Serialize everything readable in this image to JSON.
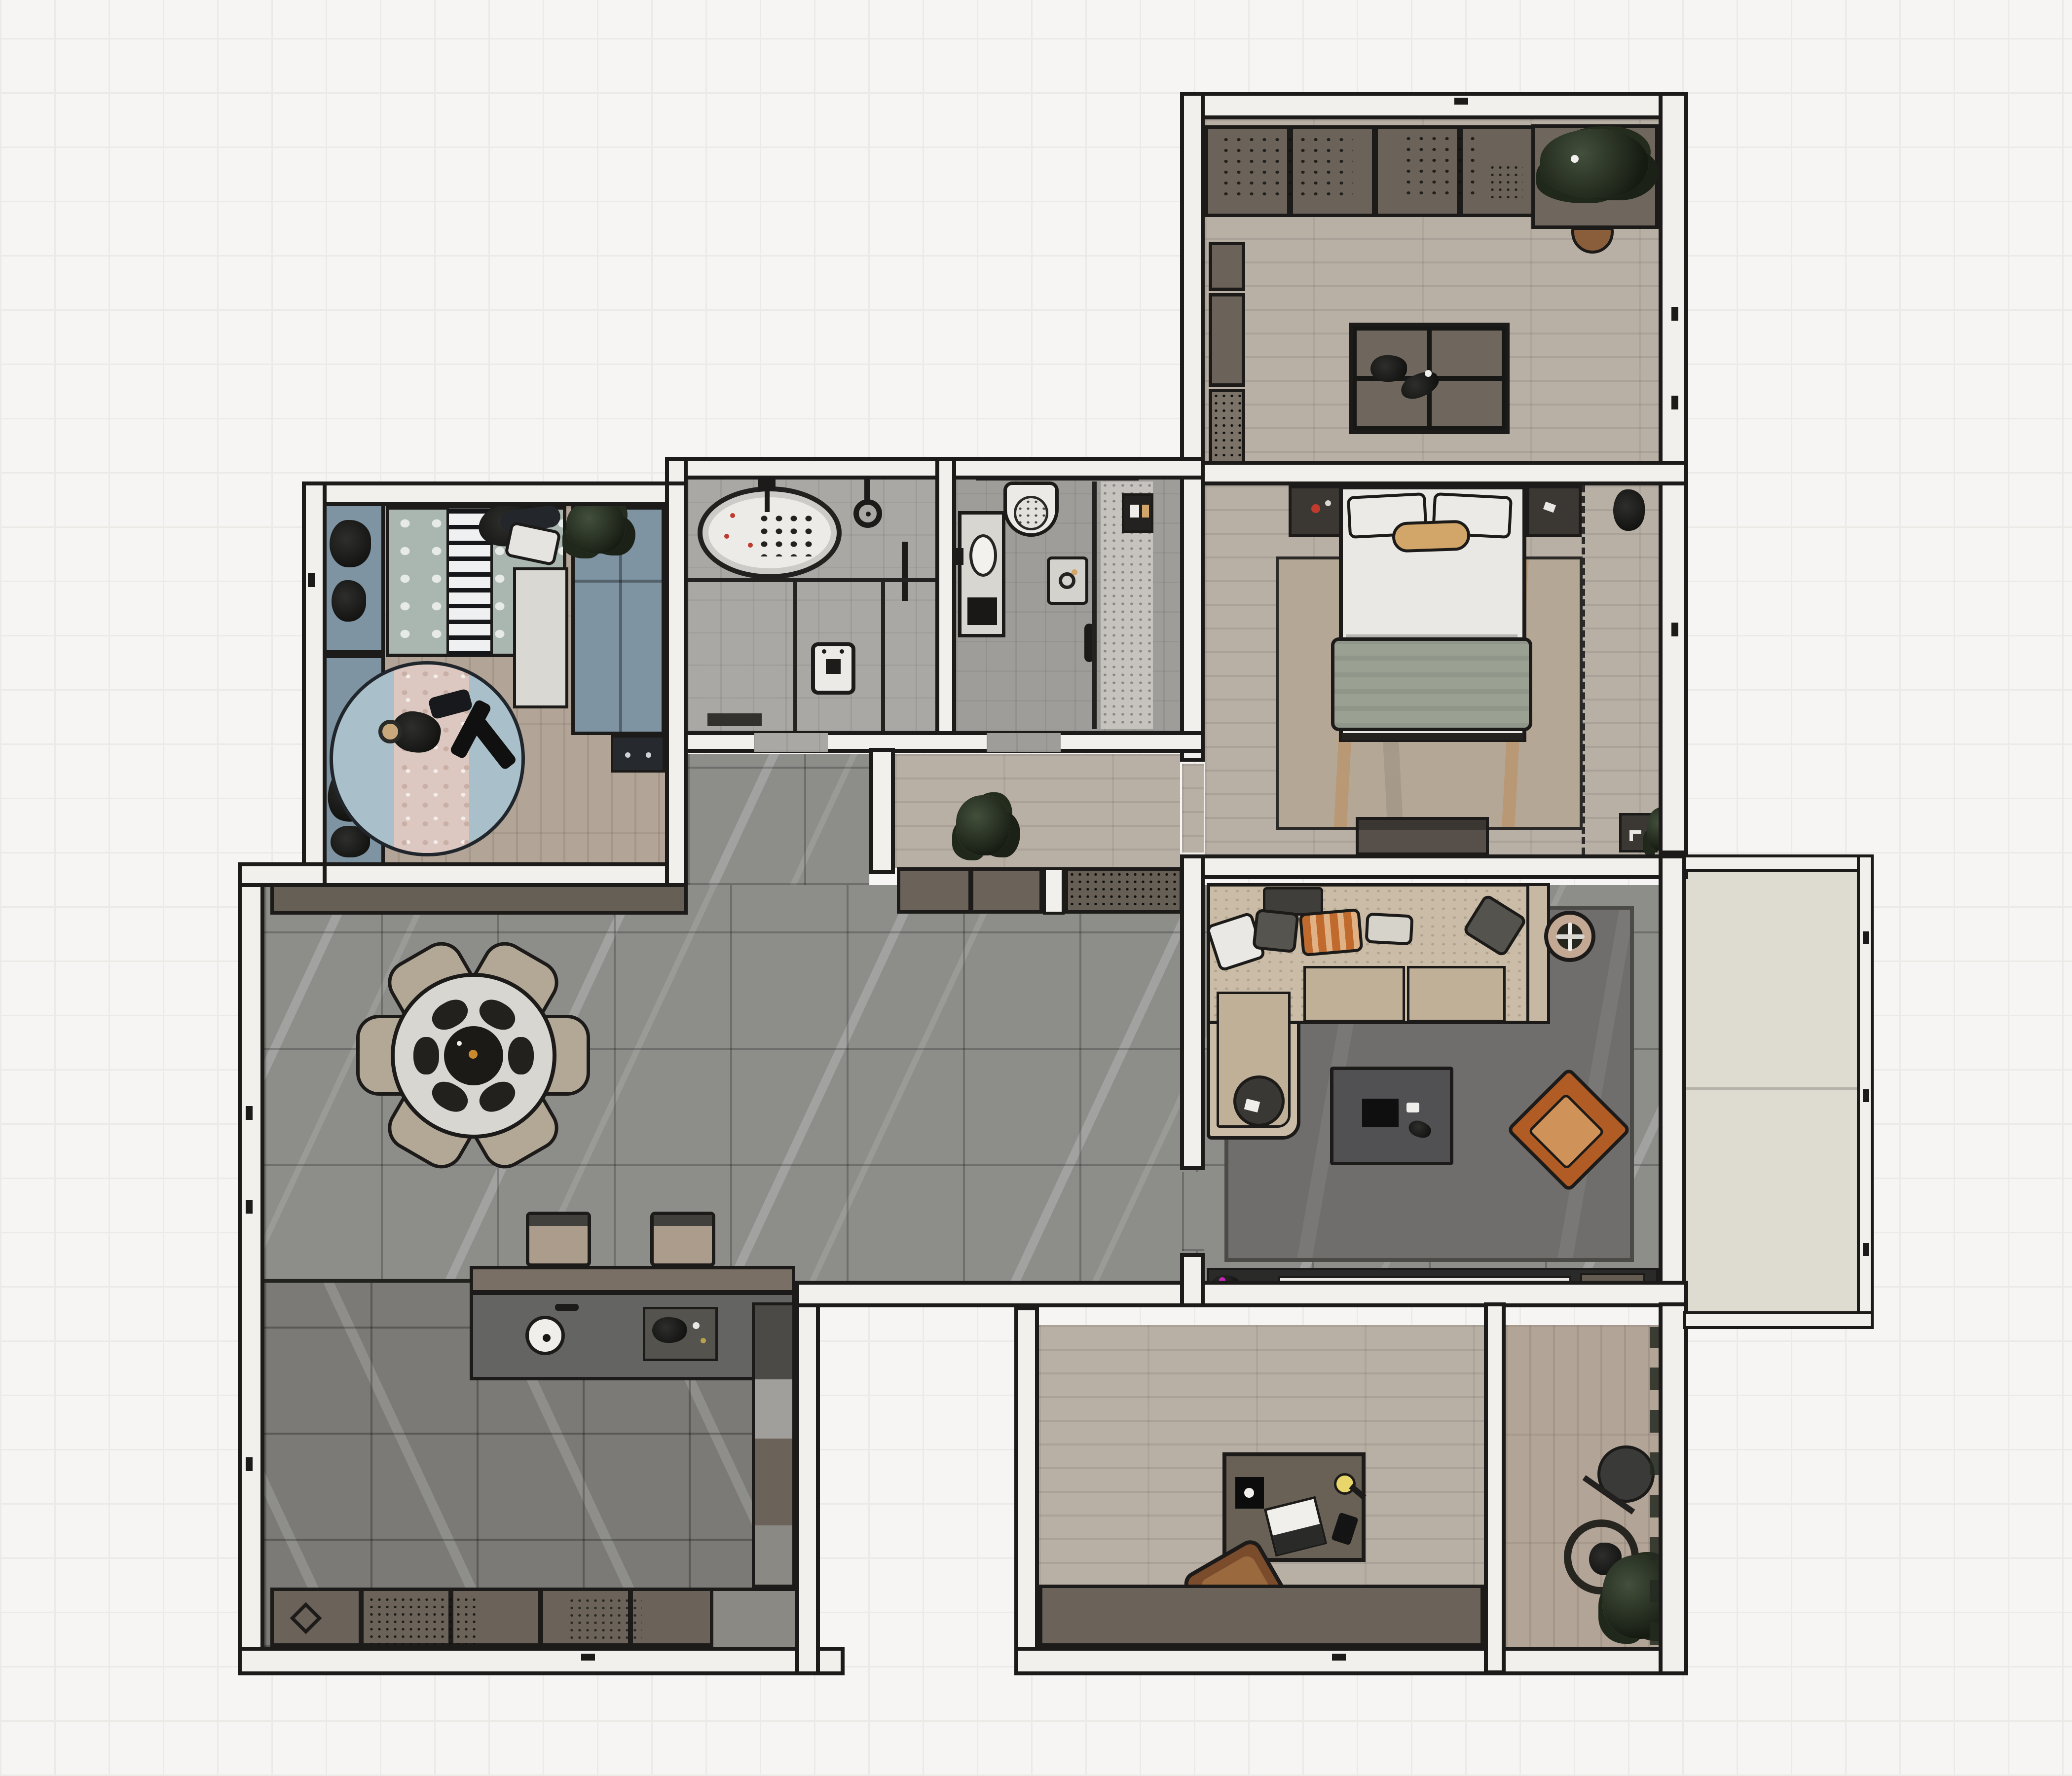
{
  "meta": {
    "title": "Apartment floor plan - rendered top-down interior view",
    "view": "2D furnished floor plan, no visible text labels"
  },
  "palette": {
    "ink": "#1c1b19",
    "wall": "#f1f0ed",
    "bg": "#f6f5f3",
    "bgGrid": "#eceae7",
    "wood": "#b9b0a5",
    "woodKids": "#b2a496",
    "tileBig": "#8d8d8a",
    "tileKitchen": "#7b7a76",
    "bath1": "#aaa8a4",
    "bath2": "#9f9d99",
    "speckleFloor": "#c6c3bf",
    "cabinet": "#6b6359",
    "cabinetLight": "#8b8984",
    "sofa": "#cabca6",
    "sofaCushion": "#c0b098",
    "rugLiving": "#6f6e6c",
    "rugBed": "#b5a795",
    "rugKids": "#a9c0ca",
    "rugKidsInner": "#dcc8c0",
    "kidsBlue": "#7e94a3",
    "duvet": "#aab6b0",
    "blanket": "#9aa193",
    "orange": "#b05c24",
    "orangeLight": "#cf9258",
    "tan": "#d2a569",
    "white": "#eceae6",
    "balcony": "#dedbd1",
    "stool": "#ab9c8b",
    "chairBrown": "#7a4c2c",
    "deskBrown": "#6a6156",
    "island": "#646462",
    "magenta": "#c427b7",
    "red": "#c03a2e"
  },
  "rooms": [
    {
      "id": "multipurpose-room",
      "label": "Multipurpose room (top right): wood floor, wall cabinets, plants, center island table, tucked chair"
    },
    {
      "id": "master-bedroom",
      "label": "Master bedroom: double bed with pillows and blanket, nightstands, area rug, media console, dashed wardrobe line"
    },
    {
      "id": "kids-bedroom",
      "label": "Kids bedroom: dotted duvet bed, striped runner, blue desk strip, wardrobe, round play rug with toys"
    },
    {
      "id": "bathroom-bathtub",
      "label": "Bathroom with oval bathtub, shower head and washing machine"
    },
    {
      "id": "bathroom-shower",
      "label": "Bathroom with toilet, vanity sink, scale and walk-in shower"
    },
    {
      "id": "hallway",
      "label": "Hallway with potted plant"
    },
    {
      "id": "dining-living-area",
      "label": "Open plan dining and living area: round table with six chairs, sideboards, sectional sofa, coffee table, orange armchair, TV wall"
    },
    {
      "id": "kitchen",
      "label": "Kitchen: island counter with sink, bar stools, base cabinets, appliance column"
    },
    {
      "id": "home-office",
      "label": "Home office: desk with lamp, laptop and speaker, swivel chair, low cabinets"
    },
    {
      "id": "utility-room",
      "label": "Utility balcony: standing fan and potted plant"
    },
    {
      "id": "balcony",
      "label": "Balcony, empty, split by floor seam"
    },
    {
      "id": "corridor",
      "label": "Corridor with tiled floor"
    }
  ],
  "furniture_icons": [
    "bathtub-icon",
    "shower-head-icon",
    "toilet-icon",
    "sink-icon",
    "washing-machine-icon",
    "bed-icon",
    "rug-icon",
    "sofa-icon",
    "coffee-table-icon",
    "armchair-icon",
    "dining-table-icon",
    "chair-icon",
    "bar-stool-icon",
    "island-counter-icon",
    "desk-icon",
    "desk-lamp-icon",
    "laptop-icon",
    "office-chair-icon",
    "standing-fan-icon",
    "potted-plant-icon",
    "tv-icon",
    "planter-icon"
  ]
}
